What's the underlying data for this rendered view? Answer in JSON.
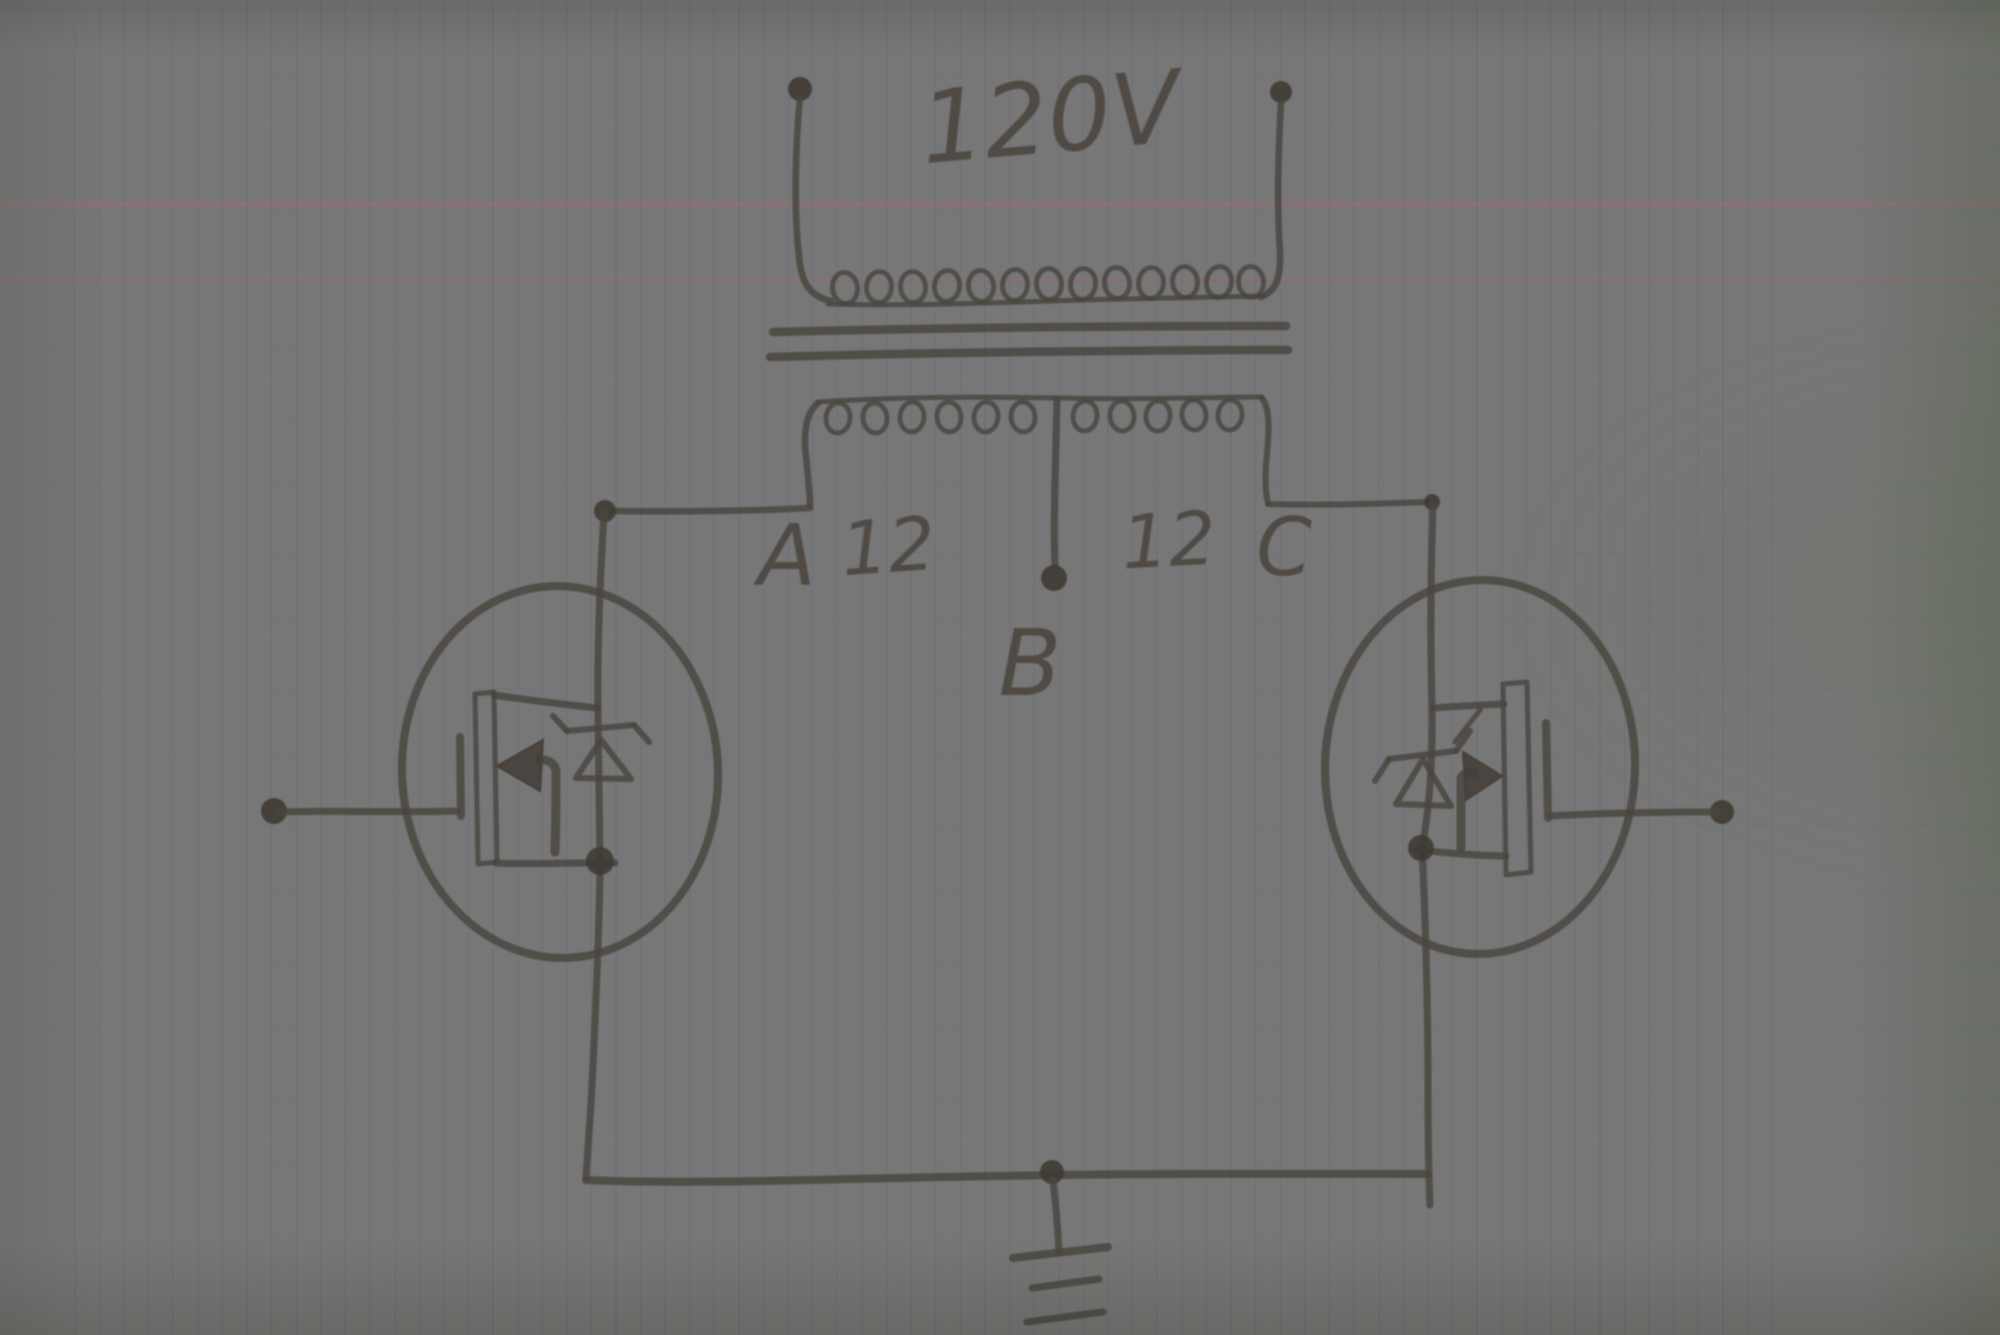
{
  "diagram": {
    "kind": "hand-drawn circuit schematic on squared notebook paper",
    "labels": {
      "primary_voltage": "120V",
      "tap_a": "A",
      "winding_left_turns": "12",
      "winding_right_turns": "12",
      "tap_c": "C",
      "tap_b": "B"
    },
    "components": {
      "transformer": {
        "primary_label": "120V",
        "secondary_center_tapped": true,
        "secondary_taps": [
          "A",
          "B",
          "C"
        ],
        "secondary_winding_labels": [
          "12",
          "12"
        ]
      },
      "mosfet_left": "MOSFET with zener body diode in circle (gate to left terminal)",
      "mosfet_right": "MOSFET with zener body diode in circle (gate to right terminal)",
      "ground": "earth ground symbol at bottom center tap of output rail"
    },
    "colors": {
      "pencil": "#4a453e",
      "paper_pink": "#efe7e2",
      "paper_green": "#cfdcc2",
      "grid_line": "#646c7a",
      "margin_rule": "#ba606a"
    }
  }
}
